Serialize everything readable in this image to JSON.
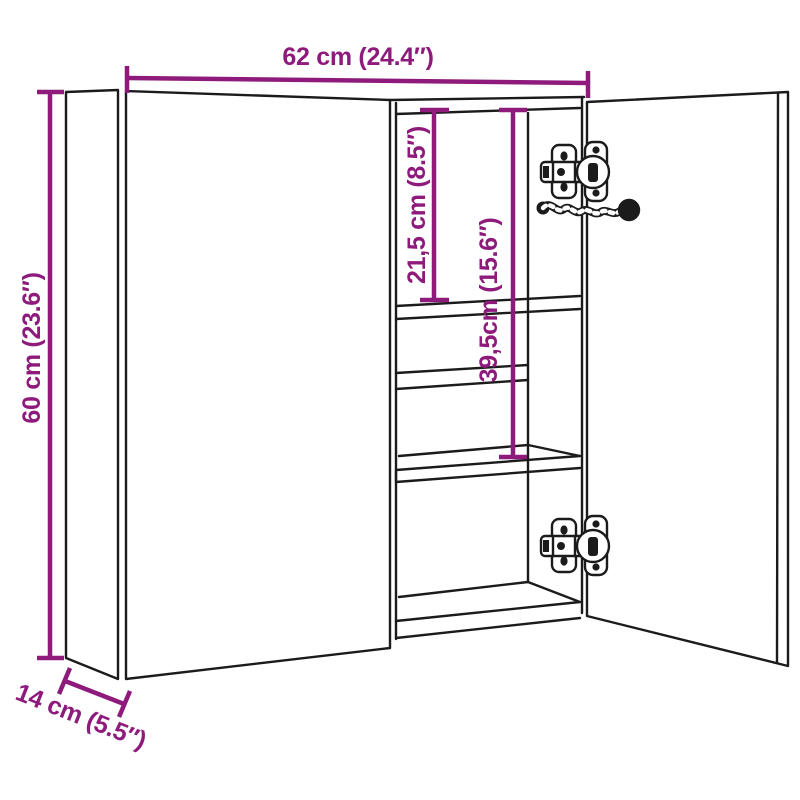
{
  "diagram": {
    "type": "product-dimension-diagram",
    "subject": "two-door mirror bathroom cabinet with shelves, concealed hinges and power cable",
    "colors": {
      "dimension": "#8E1B7C",
      "line": "#1b1b1b",
      "background": "#ffffff"
    },
    "dimensions": {
      "width": {
        "label": "62 cm (24.4″)",
        "cm": 62,
        "inches": 24.4
      },
      "height": {
        "label": "60 cm (23.6″)",
        "cm": 60,
        "inches": 23.6
      },
      "depth": {
        "label": "14 cm (5.5″)",
        "cm": 14,
        "inches": 5.5
      },
      "top_shelf_offset": {
        "label": "21,5 cm (8.5″)",
        "cm": 21.5,
        "inches": 8.5
      },
      "bottom_shelf_offset": {
        "label": "39,5cm (15.6″)",
        "cm": 39.5,
        "inches": 15.6
      }
    }
  }
}
